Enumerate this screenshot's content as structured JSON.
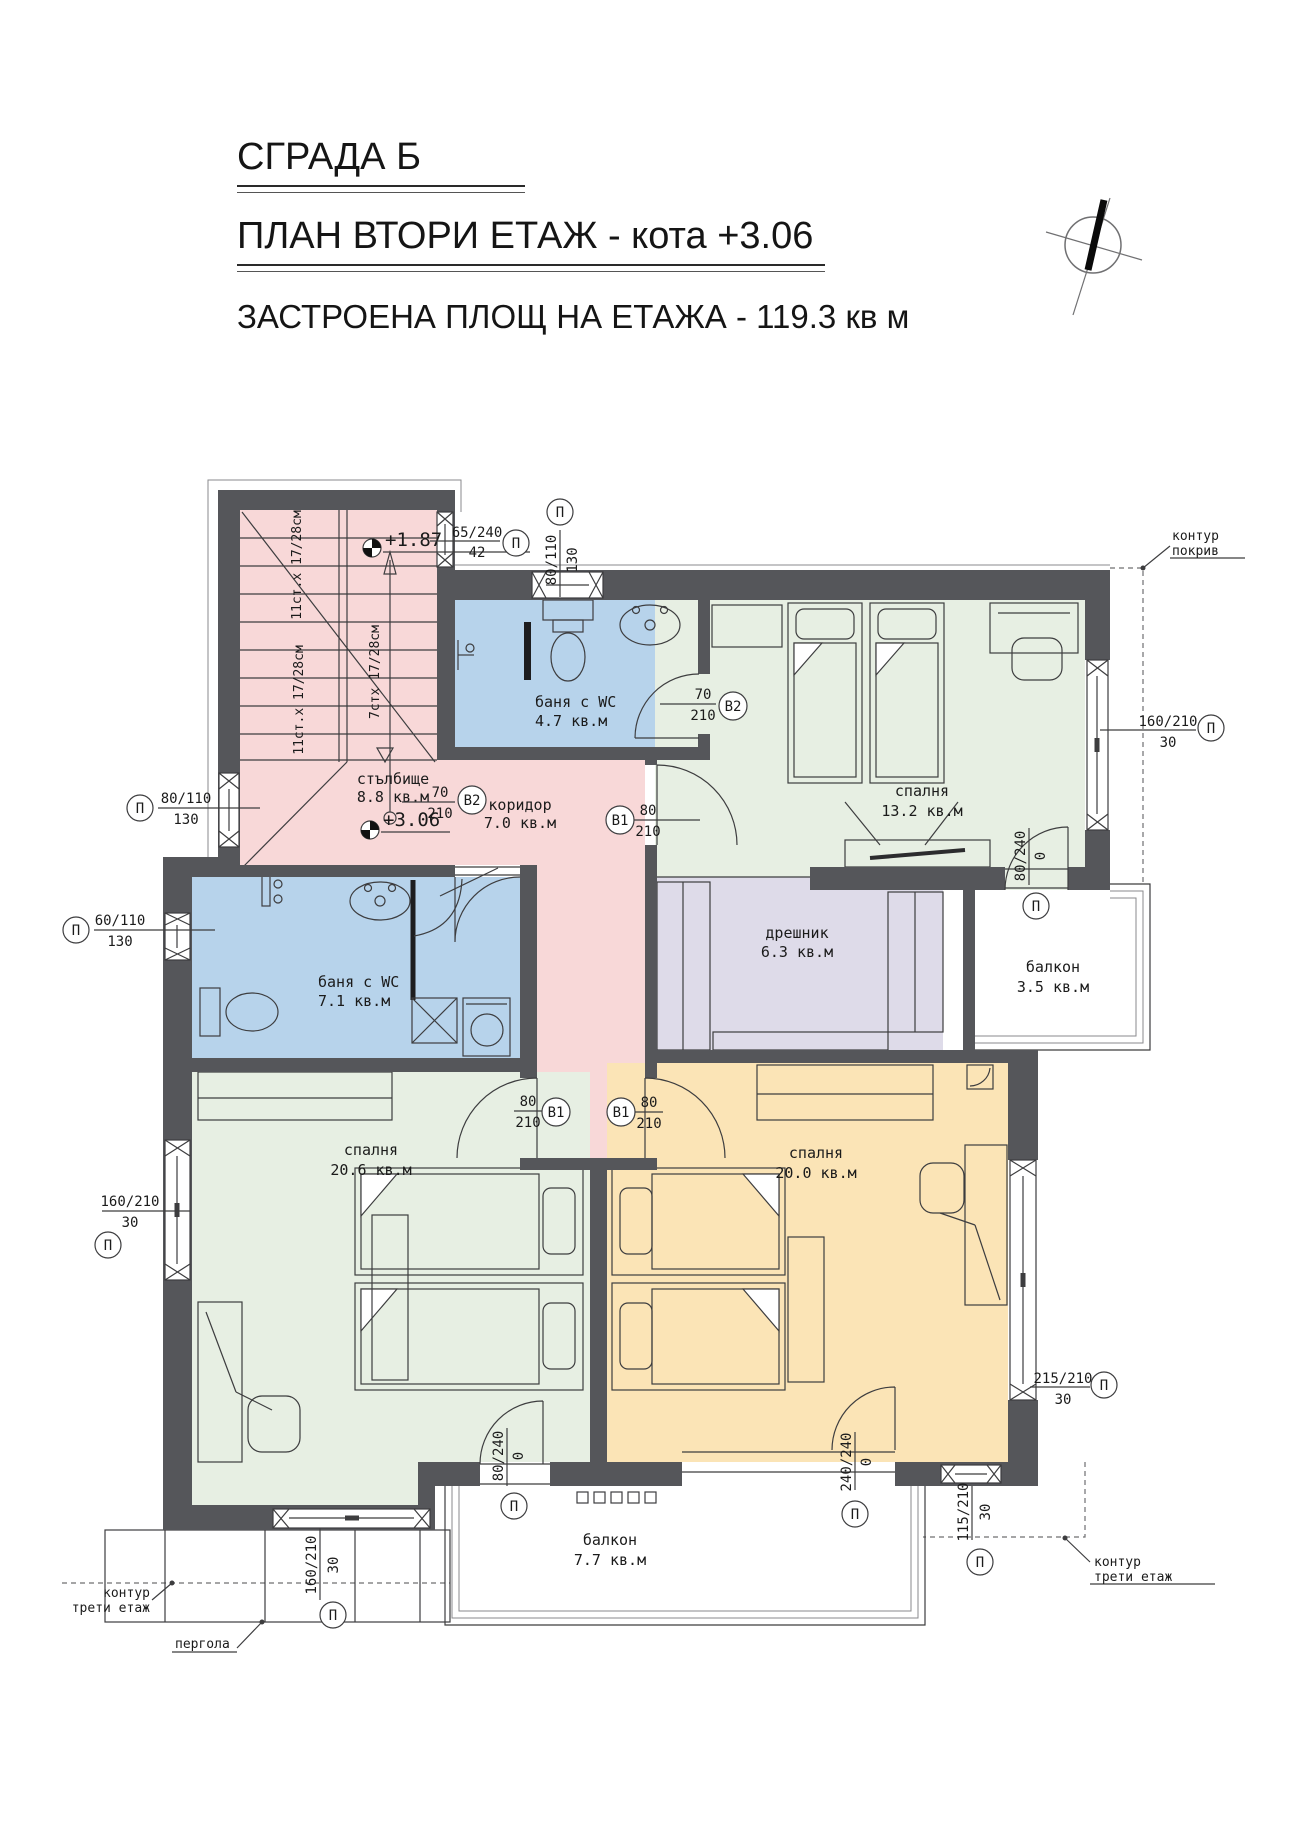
{
  "header": {
    "building": "СГРАДА Б",
    "plan": "ПЛАН ВТОРИ ЕТАЖ - кота +3.06",
    "area": "ЗАСТРОЕНА ПЛОЩ НА ЕТАЖА - 119.3 кв м"
  },
  "rooms": {
    "stairs": {
      "name": "стълбище",
      "area": "8.8 кв.м"
    },
    "corridor": {
      "name": "коридор",
      "area": "7.0 кв.м"
    },
    "bath_top": {
      "name": "баня с WC",
      "area": "4.7 кв.м"
    },
    "bath_left": {
      "name": "баня с WC",
      "area": "7.1 кв.м"
    },
    "bedroom_ne": {
      "name": "спалня",
      "area": "13.2 кв.м"
    },
    "closet": {
      "name": "дрешник",
      "area": "6.3 кв.м"
    },
    "balcony_east": {
      "name": "балкон",
      "area": "3.5 кв.м"
    },
    "bedroom_sw": {
      "name": "спалня",
      "area": "20.6 кв.м"
    },
    "bedroom_se": {
      "name": "спалня",
      "area": "20.0 кв.м"
    },
    "balcony_south": {
      "name": "балкон",
      "area": "7.7 кв.м"
    }
  },
  "levels": {
    "upper": "+1.87",
    "floor": "+3.06"
  },
  "stair_notes": {
    "a": "11ст.х 17/28см",
    "b": "11ст.х 17/28см",
    "c": "7стх 17/28см"
  },
  "openings": {
    "w65": {
      "top": "65/240",
      "bottom": "42",
      "tag": "П"
    },
    "w80t": {
      "top": "80/110",
      "bottom": "130",
      "tag": "П"
    },
    "w80l": {
      "top": "80/110",
      "bottom": "130",
      "tag": "П"
    },
    "w60": {
      "top": "60/110",
      "bottom": "130",
      "tag": "П"
    },
    "w160e": {
      "top": "160/210",
      "bottom": "30",
      "tag": "П"
    },
    "d80e": {
      "top": "80/240",
      "bottom": "0",
      "tag": "П"
    },
    "w160w": {
      "top": "160/210",
      "bottom": "30",
      "tag": "П"
    },
    "w160s": {
      "top": "160/210",
      "bottom": "30",
      "tag": "П"
    },
    "d80s": {
      "top": "80/240",
      "bottom": "0",
      "tag": "П"
    },
    "d240s": {
      "top": "240/240",
      "bottom": "0",
      "tag": "П"
    },
    "w215": {
      "top": "215/210",
      "bottom": "30",
      "tag": "П"
    },
    "w115": {
      "top": "115/210",
      "bottom": "30",
      "tag": "П"
    },
    "b2t": {
      "top": "70",
      "bottom": "210",
      "tag": "B2"
    },
    "b2l": {
      "top": "70",
      "bottom": "210",
      "tag": "B2"
    },
    "b1ne": {
      "top": "80",
      "bottom": "210",
      "tag": "B1"
    },
    "b1sw": {
      "top": "80",
      "bottom": "210",
      "tag": "B1"
    },
    "b1se": {
      "top": "80",
      "bottom": "210",
      "tag": "B1"
    }
  },
  "annotations": {
    "roof": {
      "line1": "контур",
      "line2": "покрив"
    },
    "third_right": {
      "line1": "контур",
      "line2": "трети етаж"
    },
    "third_left": {
      "line1": "контур",
      "line2": "трети етаж"
    },
    "pergola": "пергола"
  },
  "colors": {
    "wall": "#55565a",
    "stairs_fill": "#f8d8d8",
    "bath_fill": "#b7d3eb",
    "bedroom_fill": "#e7efe3",
    "bedroom_se_fill": "#fbe4b6",
    "closet_fill": "#dedbe9"
  }
}
